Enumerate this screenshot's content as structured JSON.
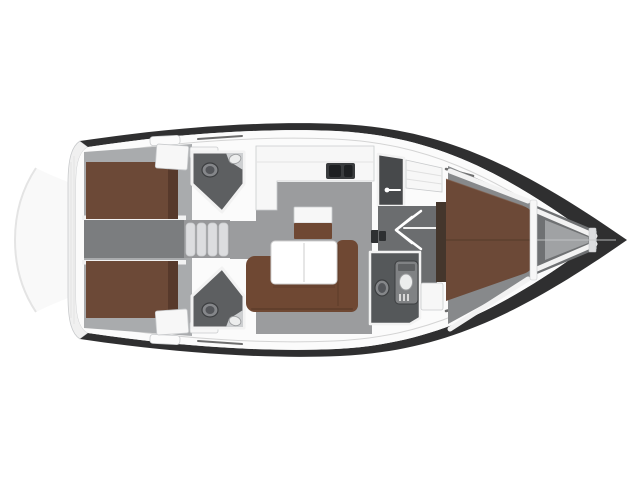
{
  "figure": {
    "kind": "sailing-yacht-interior-floor-plan",
    "orientation": "bow-right-stern-left",
    "components": [
      "aft-cabin-port",
      "aft-cabin-starboard",
      "companionway-steps",
      "aft-head-port",
      "aft-head-starboard",
      "galley",
      "salon",
      "shower-compartment",
      "forward-head",
      "forward-cabin",
      "anchor-locker"
    ]
  },
  "colors": {
    "background": "#ffffff",
    "hull_dark": "#2f2f30",
    "deck_white": "#fbfbfb",
    "deck_line": "#d4d4d4",
    "deck_mark": "#4a4a4a",
    "transom_ghost": "#f9f9f9",
    "transom_line": "#e4e4e4",
    "stern_platform": "#f0f0f0",
    "cabin_floor": "#a9abad",
    "salon_floor": "#9b9c9e",
    "corridor_floor": "#7b7d7f",
    "steps_base": "#97989a",
    "steps_tread": "#dcdddf",
    "head_floor": "#5d5f61",
    "head_fwd_floor": "#55585a",
    "shower_floor": "#47494b",
    "vestibule_floor": "#6b6d6f",
    "fwd_cabin_floor": "#87898b",
    "locker_dark": "#6f7173",
    "locker_floor": "#a0a2a4",
    "bed_brown": "#6c4937",
    "bed_shadow": "#57392b",
    "bed_seam": "#5a3e2d",
    "bed_edge_light": "#7d5844",
    "headboard_dark": "#44362c",
    "sofa_brown": "#6f4833",
    "sofa_shadow": "#533626",
    "furniture_white": "#f7f7f7",
    "fixture_white": "#eceded",
    "fixture_gray": "#808284",
    "fixture_dark": "#54565a",
    "fixture_mid": "#85878a",
    "fixture_stroke": "#3c3e40",
    "fixture_light_stroke": "#9c9ea0",
    "counter_gray": "#cdcfd1",
    "counter_edge": "#e3e3e3",
    "sink_dark": "#3a3c3e",
    "sink_bowl": "#1e2022",
    "instrument_dark": "#2e3032",
    "wall_white": "#f2f2f2",
    "wall_stroke": "#c9cbcd",
    "shelf_line": "#e0e0e0",
    "table_white": "#ffffff",
    "table_stroke": "#d0d0d0",
    "table_fold": "#dedede",
    "grate_light": "#d8d8d8",
    "vent_dark": "#5f6163",
    "pure_white": "#ffffff",
    "centerline": "#c4c6c8",
    "shadow_soft": "#000000"
  }
}
